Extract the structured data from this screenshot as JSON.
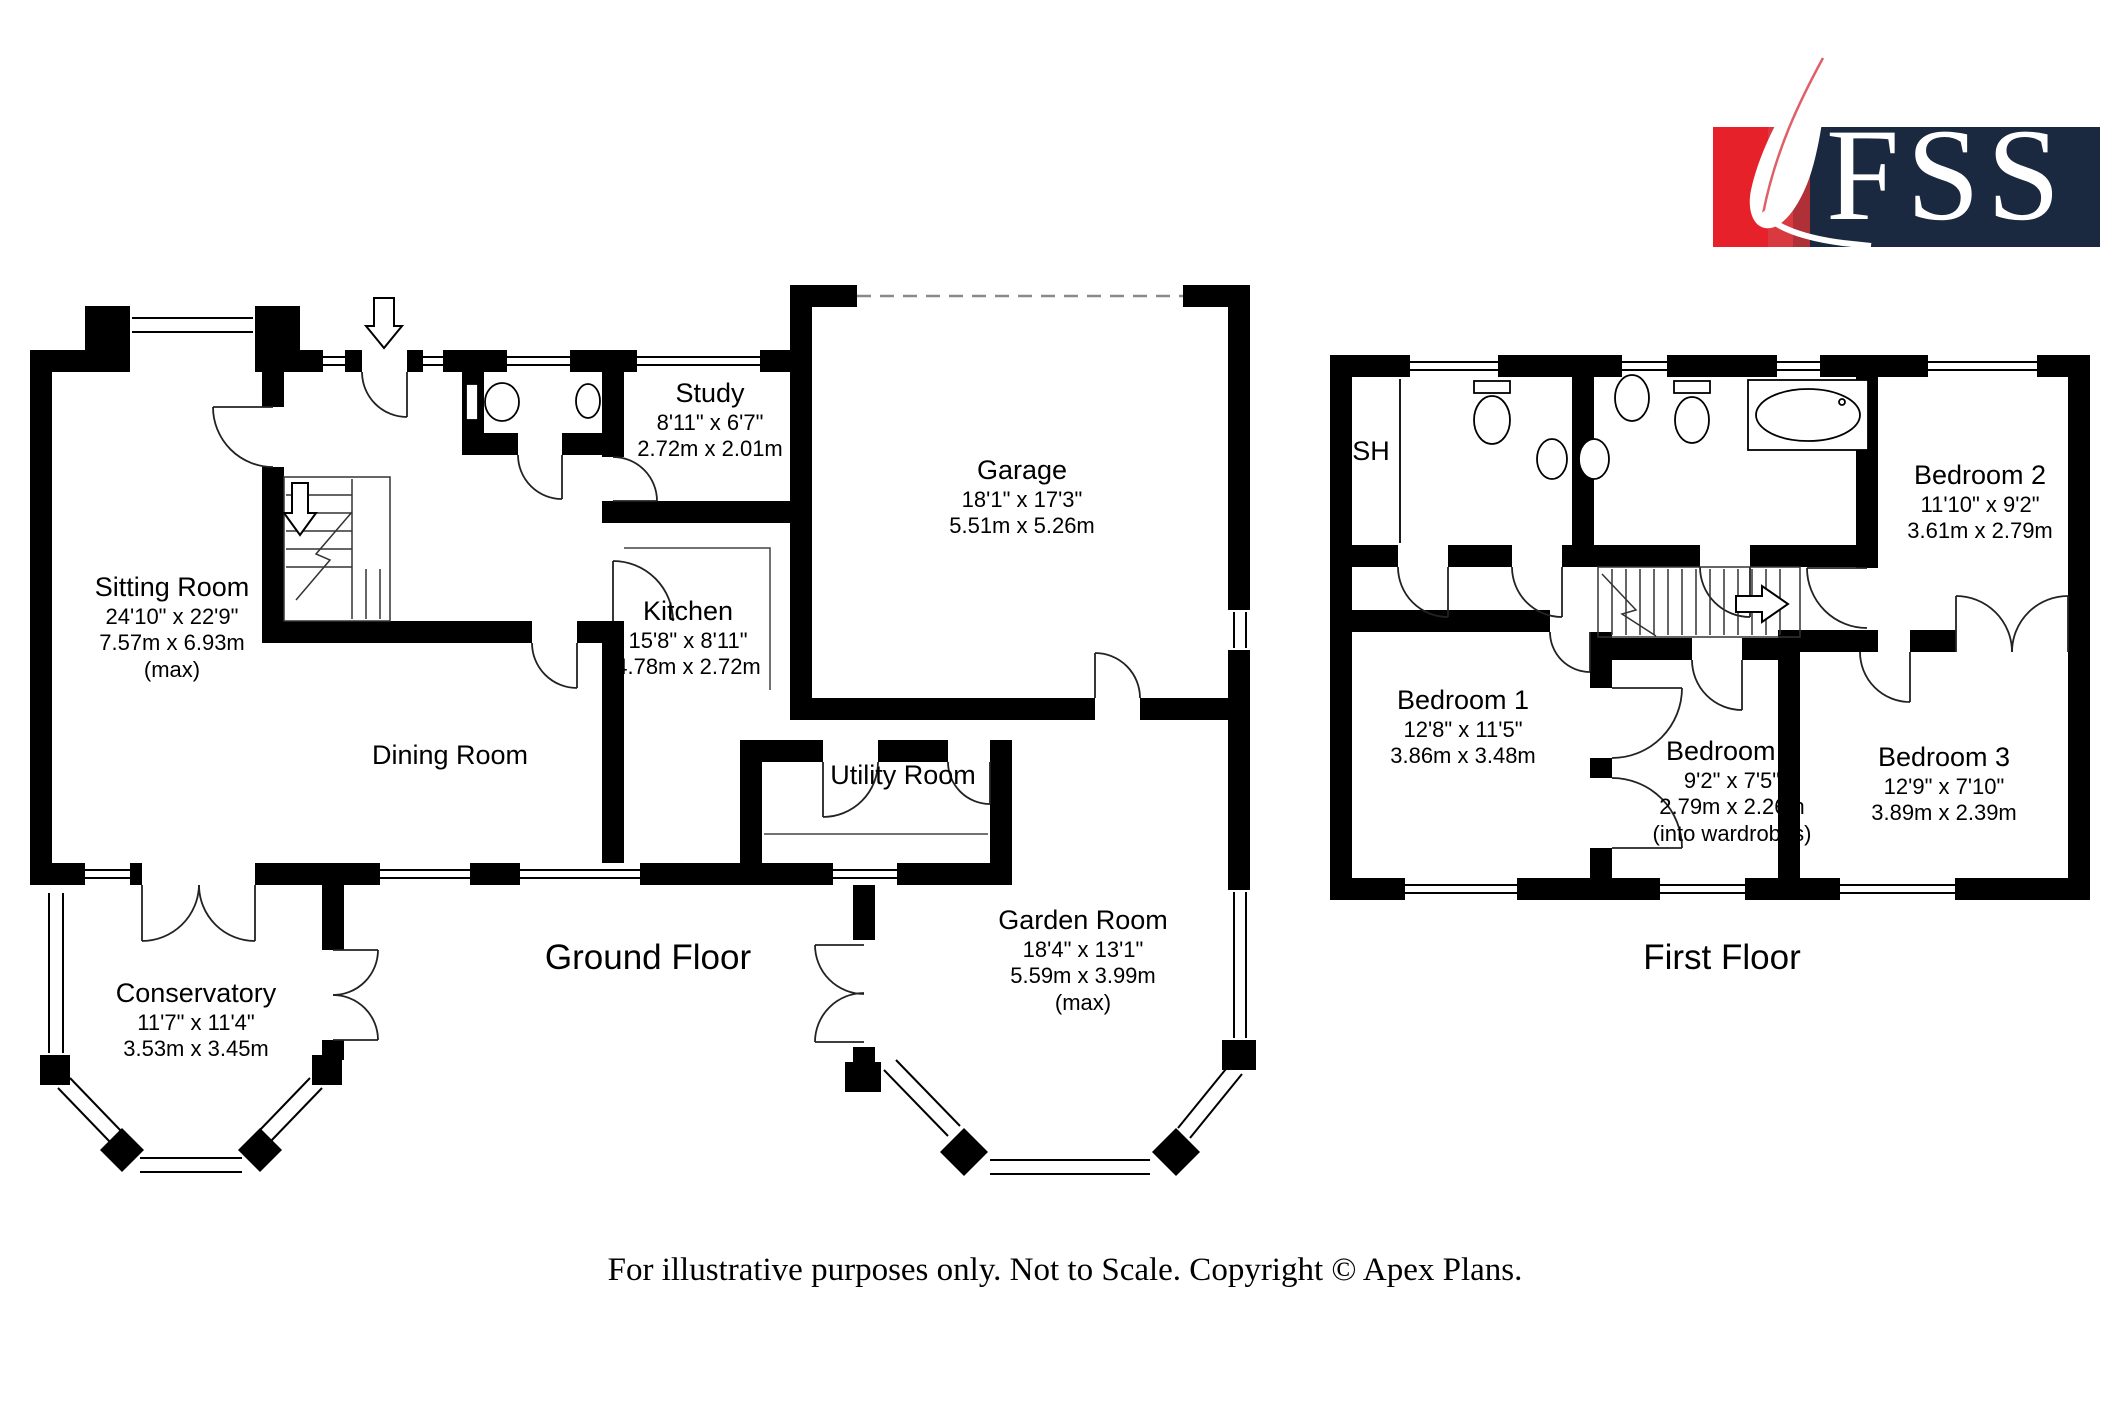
{
  "logo": {
    "brand": "FSS"
  },
  "floors": {
    "ground": {
      "caption": "Ground Floor",
      "rooms": {
        "sitting": {
          "name": "Sitting Room",
          "imperial": "24'10\" x 22'9\"",
          "metric": "7.57m x 6.93m",
          "note": "(max)"
        },
        "study": {
          "name": "Study",
          "imperial": "8'11\" x 6'7\"",
          "metric": "2.72m x 2.01m"
        },
        "garage": {
          "name": "Garage",
          "imperial": "18'1\" x 17'3\"",
          "metric": "5.51m x 5.26m"
        },
        "kitchen": {
          "name": "Kitchen",
          "imperial": "15'8\" x 8'11\"",
          "metric": "4.78m x 2.72m"
        },
        "dining": {
          "name": "Dining Room"
        },
        "utility": {
          "name": "Utility Room"
        },
        "garden": {
          "name": "Garden Room",
          "imperial": "18'4\" x 13'1\"",
          "metric": "5.59m x 3.99m",
          "note": "(max)"
        },
        "conservatory": {
          "name": "Conservatory",
          "imperial": "11'7\" x 11'4\"",
          "metric": "3.53m x 3.45m"
        }
      }
    },
    "first": {
      "caption": "First Floor",
      "rooms": {
        "sh": {
          "name": "SH"
        },
        "bed1": {
          "name": "Bedroom 1",
          "imperial": "12'8\" x 11'5\"",
          "metric": "3.86m x 3.48m"
        },
        "bed2": {
          "name": "Bedroom 2",
          "imperial": "11'10\" x 9'2\"",
          "metric": "3.61m x 2.79m"
        },
        "bed3": {
          "name": "Bedroom 3",
          "imperial": "12'9\" x 7'10\"",
          "metric": "3.89m x 2.39m"
        },
        "bed4": {
          "name": "Bedroom 4",
          "imperial": "9'2\" x 7'5\"",
          "metric": "2.79m x 2.26m",
          "note": "(into wardrobes)"
        }
      }
    }
  },
  "footer": {
    "disclaimer": "For illustrative purposes only. Not to Scale. Copyright © Apex Plans."
  },
  "colors": {
    "wall": "#000000",
    "logo_red": "#e62129",
    "logo_navy": "#1a2940"
  }
}
